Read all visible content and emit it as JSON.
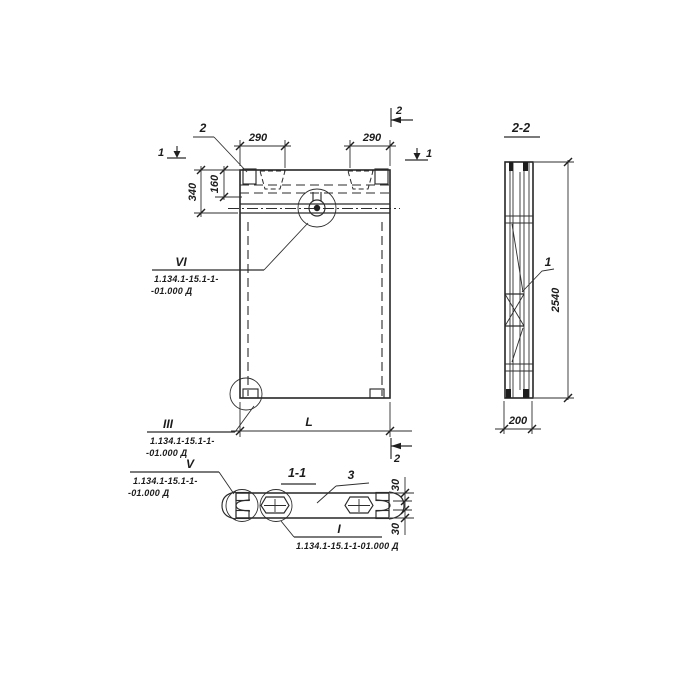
{
  "front_view": {
    "leader_2_label": "2",
    "dim_290_left": "290",
    "dim_290_right": "290",
    "dim_340": "340",
    "dim_160": "160",
    "dim_length": "L",
    "marker_1_left": "1",
    "marker_1_right": "1",
    "marker_2_top": "2",
    "marker_2_bottom": "2"
  },
  "side_view": {
    "title": "2-2",
    "dim_2540": "2540",
    "dim_200": "200",
    "leader_1_label": "1"
  },
  "section_view": {
    "title": "1-1",
    "leader_3_label": "3",
    "dim_30_top": "30",
    "dim_30_bottom": "30"
  },
  "callouts": {
    "vi": {
      "numeral": "VI",
      "line1": "1.134.1-15.1-1-",
      "line2": "-01.000 Д"
    },
    "iii": {
      "numeral": "III",
      "line1": "1.134.1-15.1-1-",
      "line2": "-01.000 Д"
    },
    "v": {
      "numeral": "V",
      "line1": "1.134.1-15.1-1-",
      "line2": "-01.000 Д"
    },
    "i": {
      "numeral": "I",
      "line1": "1.134.1-15.1-1-01.000 Д"
    }
  }
}
